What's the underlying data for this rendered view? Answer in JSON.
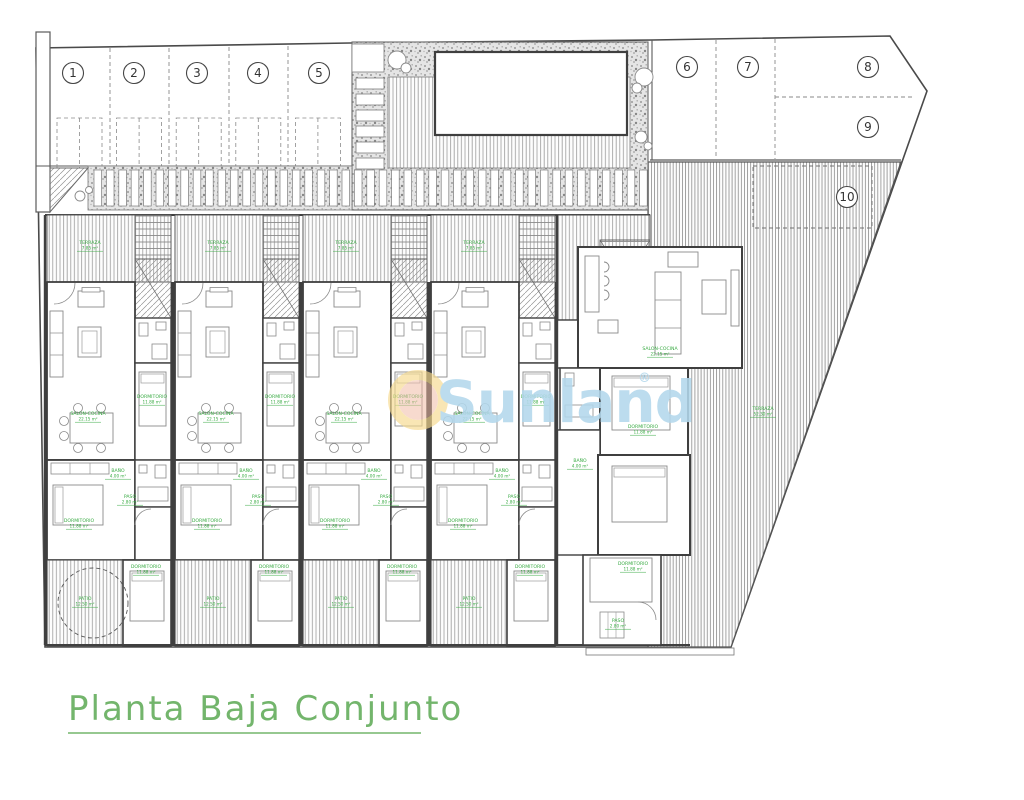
{
  "plan": {
    "title": "Planta Baja Conjunto",
    "title_color": "#73b56c",
    "label_color": "#3aab44",
    "line_color": "#4a4a4a",
    "watermark": {
      "brand": "Sunland",
      "registered": "®",
      "text_color": "#b3d8ec",
      "ring_color": "#f6d98d",
      "core_color": "#f0b9a4"
    },
    "parking_spaces": [
      {
        "label": "1",
        "x": 73,
        "y": 73
      },
      {
        "label": "2",
        "x": 134,
        "y": 73
      },
      {
        "label": "3",
        "x": 197,
        "y": 73
      },
      {
        "label": "4",
        "x": 258,
        "y": 73
      },
      {
        "label": "5",
        "x": 319,
        "y": 73
      },
      {
        "label": "6",
        "x": 687,
        "y": 67
      },
      {
        "label": "7",
        "x": 748,
        "y": 67
      },
      {
        "label": "8",
        "x": 868,
        "y": 67
      },
      {
        "label": "9",
        "x": 868,
        "y": 127
      },
      {
        "label": "10",
        "x": 847,
        "y": 197
      }
    ],
    "room_types": {
      "terraza": {
        "name": "TERRAZA",
        "area": "7.85 m²"
      },
      "terraza_big": {
        "name": "TERRAZA",
        "area": "52.30 m²"
      },
      "salon": {
        "name": "SALON-COCINA",
        "area": "22.15 m²"
      },
      "dormitorio": {
        "name": "DORMITORIO",
        "area": "11.88 m²"
      },
      "bano": {
        "name": "BAÑO",
        "area": "4.00 m²"
      },
      "paso": {
        "name": "PASO",
        "area": "2.80 m²"
      },
      "patio": {
        "name": "PATIO",
        "area": "12.50 m²"
      }
    },
    "room_labels": [
      {
        "type": "terraza",
        "x": 90,
        "y": 244
      },
      {
        "type": "terraza",
        "x": 218,
        "y": 244
      },
      {
        "type": "terraza",
        "x": 346,
        "y": 244
      },
      {
        "type": "terraza",
        "x": 474,
        "y": 244
      },
      {
        "type": "terraza_big",
        "x": 763,
        "y": 410
      },
      {
        "type": "salon",
        "x": 88,
        "y": 415
      },
      {
        "type": "salon",
        "x": 216,
        "y": 415
      },
      {
        "type": "salon",
        "x": 344,
        "y": 415
      },
      {
        "type": "salon",
        "x": 472,
        "y": 415
      },
      {
        "type": "salon",
        "x": 660,
        "y": 350
      },
      {
        "type": "dormitorio",
        "x": 152,
        "y": 398
      },
      {
        "type": "dormitorio",
        "x": 280,
        "y": 398
      },
      {
        "type": "dormitorio",
        "x": 408,
        "y": 398
      },
      {
        "type": "dormitorio",
        "x": 536,
        "y": 398
      },
      {
        "type": "dormitorio",
        "x": 79,
        "y": 522
      },
      {
        "type": "dormitorio",
        "x": 207,
        "y": 522
      },
      {
        "type": "dormitorio",
        "x": 335,
        "y": 522
      },
      {
        "type": "dormitorio",
        "x": 463,
        "y": 522
      },
      {
        "type": "dormitorio",
        "x": 146,
        "y": 568
      },
      {
        "type": "dormitorio",
        "x": 274,
        "y": 568
      },
      {
        "type": "dormitorio",
        "x": 402,
        "y": 568
      },
      {
        "type": "dormitorio",
        "x": 530,
        "y": 568
      },
      {
        "type": "bano",
        "x": 118,
        "y": 472
      },
      {
        "type": "bano",
        "x": 246,
        "y": 472
      },
      {
        "type": "bano",
        "x": 374,
        "y": 472
      },
      {
        "type": "bano",
        "x": 502,
        "y": 472
      },
      {
        "type": "paso",
        "x": 130,
        "y": 498
      },
      {
        "type": "paso",
        "x": 258,
        "y": 498
      },
      {
        "type": "paso",
        "x": 386,
        "y": 498
      },
      {
        "type": "paso",
        "x": 514,
        "y": 498
      },
      {
        "type": "patio",
        "x": 85,
        "y": 600
      },
      {
        "type": "patio",
        "x": 213,
        "y": 600
      },
      {
        "type": "patio",
        "x": 341,
        "y": 600
      },
      {
        "type": "patio",
        "x": 469,
        "y": 600
      },
      {
        "type": "dormitorio",
        "x": 643,
        "y": 428
      },
      {
        "type": "bano",
        "x": 580,
        "y": 462
      },
      {
        "type": "dormitorio",
        "x": 633,
        "y": 565
      },
      {
        "type": "paso",
        "x": 618,
        "y": 622
      }
    ]
  }
}
